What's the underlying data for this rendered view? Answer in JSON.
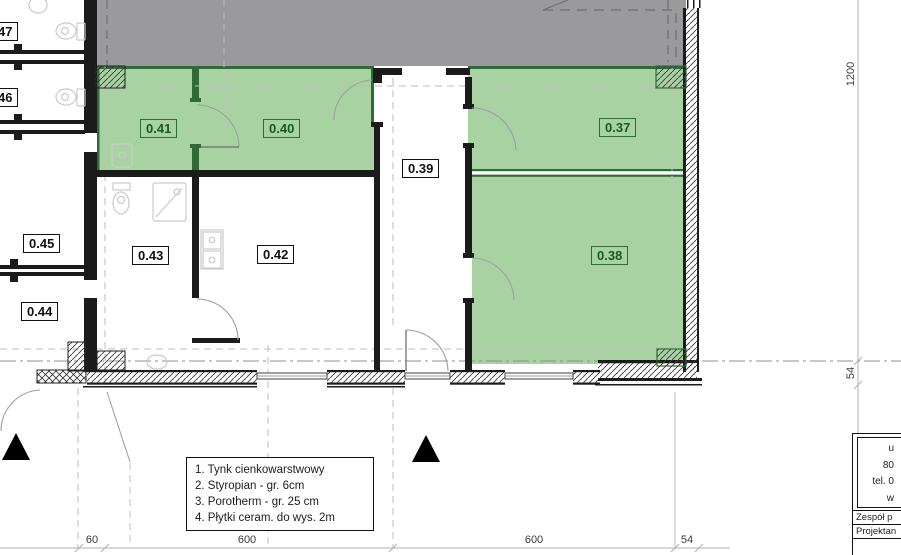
{
  "drawing": {
    "type": "architectural-floor-plan",
    "colors": {
      "room_highlight_green": "#a9d2a3",
      "green_wall": "#2e6b37",
      "green_label_text": "#19591f",
      "building_mass_gray": "#9a999c",
      "wall_black": "#1b1b1b"
    }
  },
  "plan": {
    "rooms": [
      {
        "key": "r047",
        "label": "47",
        "highlight": false
      },
      {
        "key": "r046",
        "label": "46",
        "highlight": false
      },
      {
        "key": "r045",
        "label": "0.45",
        "highlight": false
      },
      {
        "key": "r044",
        "label": "0.44",
        "highlight": false
      },
      {
        "key": "r043",
        "label": "0.43",
        "highlight": false
      },
      {
        "key": "r042",
        "label": "0.42",
        "highlight": false
      },
      {
        "key": "r039",
        "label": "0.39",
        "highlight": false
      },
      {
        "key": "r041",
        "label": "0.41",
        "highlight": true
      },
      {
        "key": "r040",
        "label": "0.40",
        "highlight": true
      },
      {
        "key": "r037",
        "label": "0.37",
        "highlight": true
      },
      {
        "key": "r038",
        "label": "0.38",
        "highlight": true
      }
    ]
  },
  "dimensions": {
    "bottom": [
      "60",
      "600",
      "600",
      "54"
    ],
    "right": [
      "1200",
      "54"
    ]
  },
  "legend": {
    "lines": [
      "1. Tynk cienkowarstwowy",
      "2. Styropian - gr.  6cm",
      "3. Porotherm - gr. 25 cm",
      "4. Płytki ceram. do wys. 2m"
    ]
  },
  "title_block": {
    "address_fragments": [
      "u",
      "80",
      "tel. 0",
      "w"
    ],
    "rows": [
      "Zespół p",
      "Projektan"
    ]
  }
}
